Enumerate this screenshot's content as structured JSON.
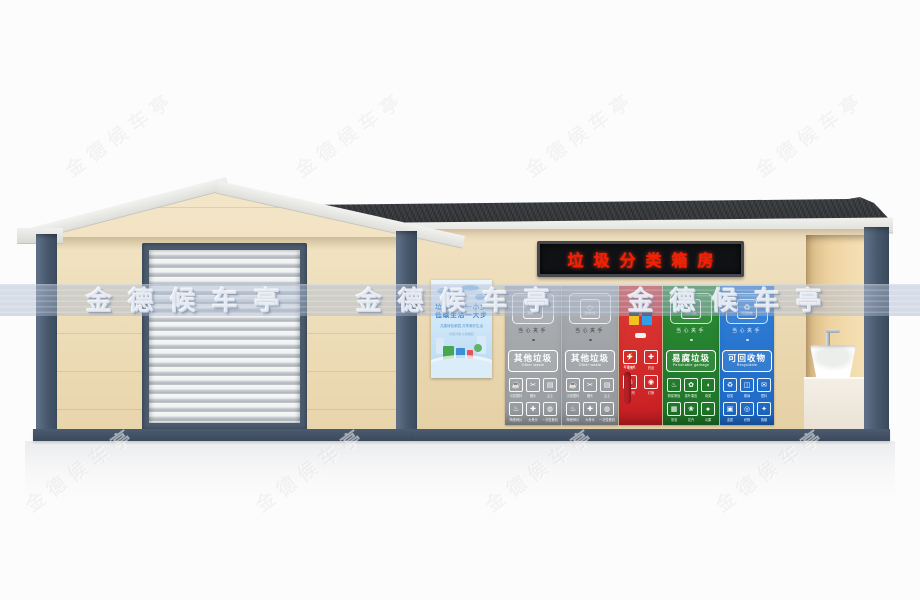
{
  "watermark": {
    "text": "金德候车亭"
  },
  "led_sign": {
    "text": "垃圾分类箱房",
    "text_color": "#f41f06",
    "bg_color": "#101114"
  },
  "poster": {
    "title_line1": "垃圾分类一小步",
    "title_line2": "低碳生活一大步",
    "subtitle": "共建绿色家园 共享美好生活",
    "footer": "垃圾分类 从我做起"
  },
  "bins": {
    "caution_label": "当心夹手",
    "panels": [
      {
        "kind": "chute",
        "variant": "gray",
        "color_top": "#aeb2b5",
        "color_bottom": "#979b9f",
        "name_cn": "其他垃圾",
        "name_en": "Other waste",
        "chute_glyph": "◇",
        "chute_tag": "其他垃圾",
        "icons": [
          {
            "glyph": "☕",
            "label": "污损塑料"
          },
          {
            "glyph": "✂",
            "label": "烟头"
          },
          {
            "glyph": "▤",
            "label": "尘土"
          },
          {
            "glyph": "♨",
            "label": "陶瓷碎片"
          },
          {
            "glyph": "✚",
            "label": "大骨头"
          },
          {
            "glyph": "◍",
            "label": "一次性餐具"
          }
        ]
      },
      {
        "kind": "chute",
        "variant": "gray",
        "color_top": "#aaaeb1",
        "color_bottom": "#94989c",
        "name_cn": "其他垃圾",
        "name_en": "Other waste",
        "chute_glyph": "◇",
        "chute_tag": "其他垃圾",
        "icons": [
          {
            "glyph": "☕",
            "label": "污损塑料"
          },
          {
            "glyph": "✂",
            "label": "烟头"
          },
          {
            "glyph": "▤",
            "label": "尘土"
          },
          {
            "glyph": "♨",
            "label": "陶瓷碎片"
          },
          {
            "glyph": "✚",
            "label": "大骨头"
          },
          {
            "glyph": "◍",
            "label": "一次性餐具"
          }
        ]
      },
      {
        "kind": "hazardous",
        "variant": "red",
        "color_top": "#de3b36",
        "color_bottom": "#c91e23",
        "mini_label": "有害垃圾",
        "icons": [
          {
            "glyph": "⚡",
            "label": "电池"
          },
          {
            "glyph": "✚",
            "label": "药品"
          },
          {
            "glyph": "☠",
            "label": "杀虫剂"
          },
          {
            "glyph": "◉",
            "label": "灯管"
          }
        ]
      },
      {
        "kind": "chute",
        "variant": "green",
        "color_top": "#2c8c35",
        "color_bottom": "#1d7427",
        "name_cn": "易腐垃圾",
        "name_en": "Perishable garbage",
        "chute_glyph": "♨",
        "chute_tag": "易腐垃圾",
        "icons": [
          {
            "glyph": "♨",
            "label": "剩菜剩饭"
          },
          {
            "glyph": "✿",
            "label": "菜叶果皮"
          },
          {
            "glyph": "◖",
            "label": "肉类"
          },
          {
            "glyph": "▦",
            "label": "茶渣"
          },
          {
            "glyph": "❀",
            "label": "花卉"
          },
          {
            "glyph": "●",
            "label": "瓜果"
          }
        ]
      },
      {
        "kind": "chute",
        "variant": "blue",
        "color_top": "#3181d8",
        "color_bottom": "#1c67c5",
        "name_cn": "可回收物",
        "name_en": "Recyclable",
        "chute_glyph": "♻",
        "chute_tag": "可回收物",
        "icons": [
          {
            "glyph": "♻",
            "label": "纸类"
          },
          {
            "glyph": "◫",
            "label": "玻璃"
          },
          {
            "glyph": "✉",
            "label": "塑料"
          },
          {
            "glyph": "▣",
            "label": "金属"
          },
          {
            "glyph": "◎",
            "label": "织物"
          },
          {
            "glyph": "✦",
            "label": "瓶罐"
          }
        ]
      }
    ]
  },
  "colors": {
    "wall_cream": "#ecdcba",
    "trim_slate": "#47586c",
    "roof_dark": "#36383b",
    "fascia_white": "#e9e9e5",
    "base_dark": "#42526480"
  }
}
